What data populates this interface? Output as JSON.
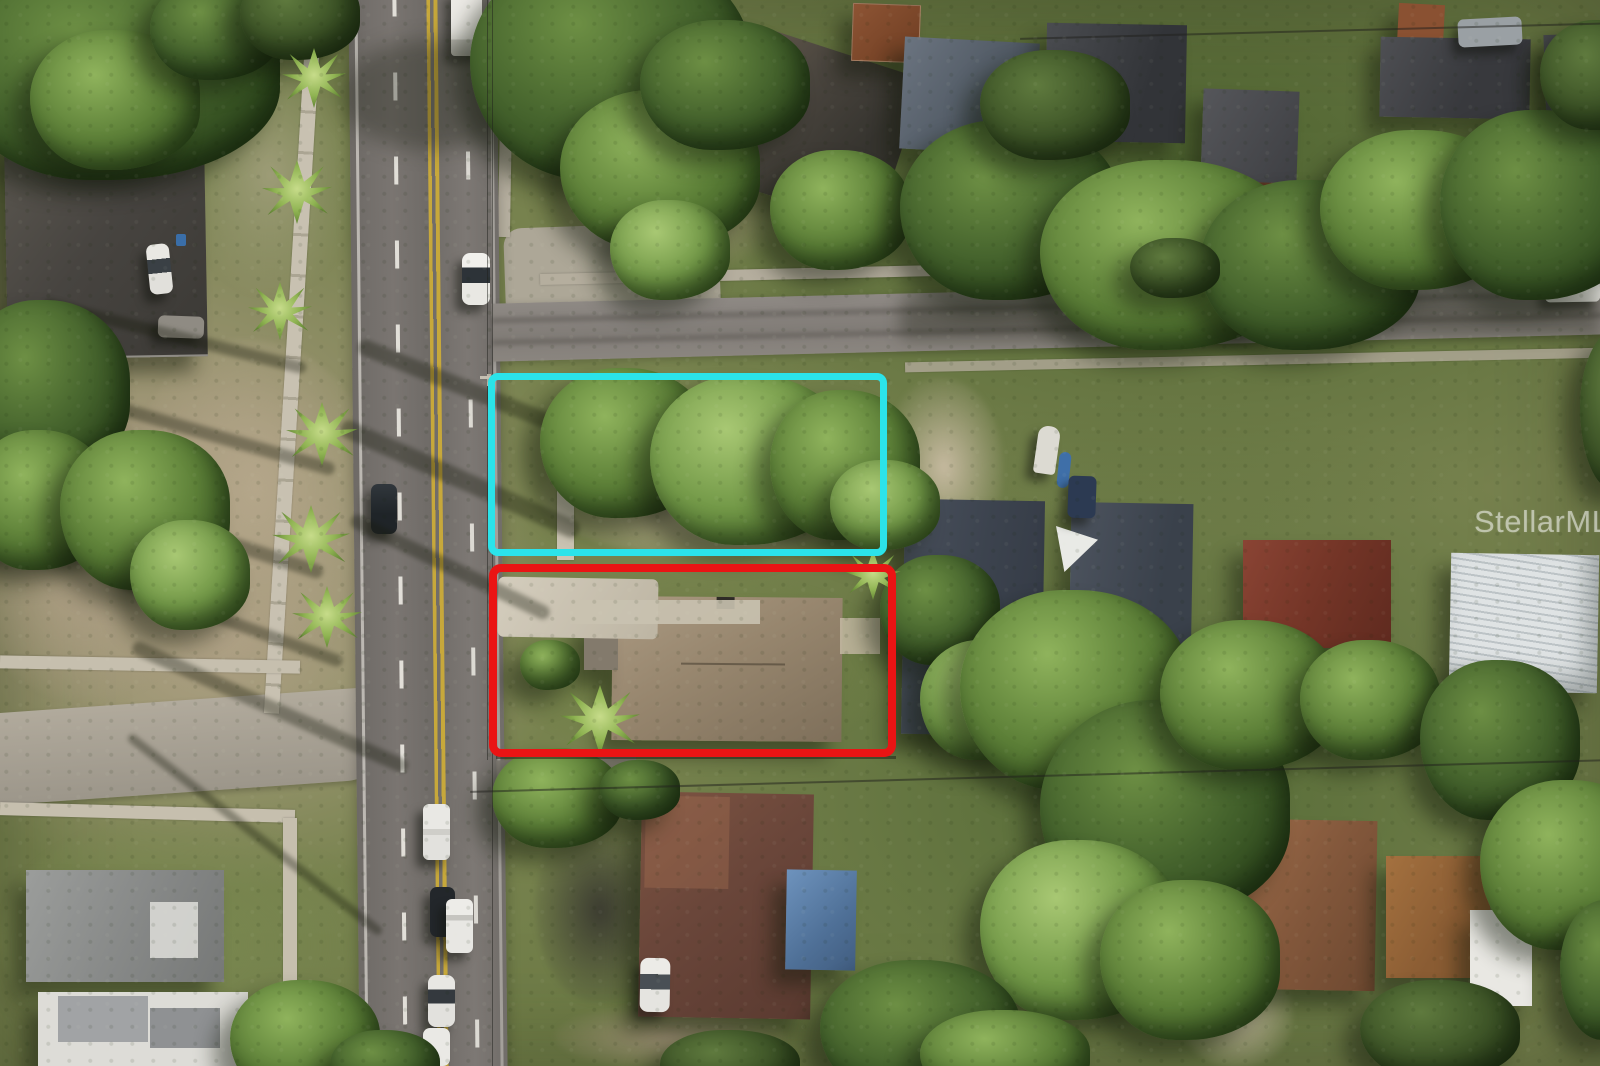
{
  "photo": {
    "kind": "aerial drone photograph",
    "description": "Overhead aerial view of a residential neighborhood: a two-lane road with double yellow center line runs vertically; a cyan rectangle outlines a vacant treed corner lot and a red rectangle outlines the adjacent lot with a tan hip-roof house; dense tree canopy, side streets, sidewalks and parked vehicles surround them.",
    "watermark": "StellarMLS"
  },
  "annotations": {
    "cyan_outline_color": "#2BE3EA",
    "red_outline_color": "#EA1414"
  },
  "palette": {
    "asphalt": "#716D69",
    "concrete": "#C6BFAE",
    "lane_yellow": "#C7A83B",
    "grass": "#77824E",
    "canopy_dark": "#2E4A1C",
    "canopy_light": "#8FB35C",
    "sand": "#BCAE94",
    "roof_slate": "#3F4550",
    "roof_tan": "#97866E",
    "roof_rust": "#8D5434",
    "roof_brown": "#82573B",
    "roof_white_metal": "#D8DCDD",
    "tarp_blue": "#5B80A9"
  }
}
